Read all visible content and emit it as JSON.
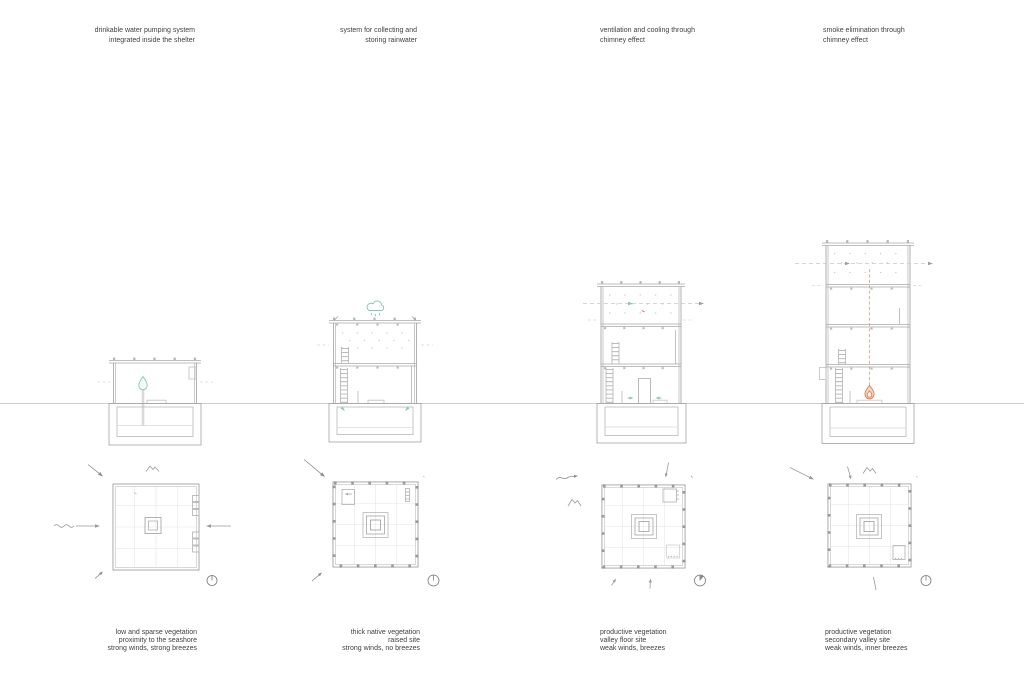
{
  "page": {
    "background": "#ffffff",
    "description": "architectural diagram of four shelter variants: sections over a shared ground line, site plans below, environmental strategy notes top and site condition notes bottom"
  },
  "colors": {
    "ground_line": "#cccccc",
    "wall_line": "#9f9f9f",
    "light_line": "#c6c6c6",
    "text": "#3f3f3f",
    "accent_teal": "#84c7b5",
    "accent_orange": "#e0784e"
  },
  "icons": {
    "water_drop": "water-drop-icon",
    "rain_cloud": "rain-cloud-icon",
    "flame": "flame-icon",
    "airflow_arrow": "airflow-arrow-icon",
    "wind_arrow": "wind-arrow-icon",
    "breeze_arrow": "breeze-arrow-icon",
    "sea_waves": "sea-waves-icon",
    "mountain": "mountain-icon",
    "north_arrow": "north-arrow-icon"
  },
  "columns": [
    {
      "top_note": {
        "align": "right",
        "lines": [
          "drinkable water pumping system",
          "integrated inside the shelter"
        ]
      },
      "bottom_note": {
        "align": "right",
        "lines": [
          "low and sparse vegetation",
          "proximity to the seashore",
          "strong winds, strong breezes"
        ]
      },
      "section": {
        "name": "section-1",
        "floors": 1,
        "feature_icons": [
          "water-drop-icon"
        ]
      },
      "plan": {
        "name": "plan-1",
        "site_icons": [
          "wind-arrow-icon",
          "mountain-icon",
          "sea-waves-icon",
          "breeze-arrow-icon",
          "north-arrow-icon"
        ]
      }
    },
    {
      "top_note": {
        "align": "right",
        "lines": [
          "system for collecting and",
          "storing rainwater"
        ]
      },
      "bottom_note": {
        "align": "right",
        "lines": [
          "thick native vegetation",
          "raised site",
          "strong winds, no breezes"
        ]
      },
      "section": {
        "name": "section-2",
        "floors": 2,
        "feature_icons": [
          "rain-cloud-icon"
        ]
      },
      "plan": {
        "name": "plan-2",
        "site_icons": [
          "wind-arrow-icon",
          "breeze-arrow-icon",
          "north-arrow-icon"
        ]
      }
    },
    {
      "top_note": {
        "align": "left",
        "lines": [
          "ventilation and cooling through",
          "chimney effect"
        ]
      },
      "bottom_note": {
        "align": "left",
        "lines": [
          "productive vegetation",
          "valley floor site",
          "weak winds, breezes"
        ]
      },
      "section": {
        "name": "section-3",
        "floors": 3,
        "feature_icons": [
          "airflow-arrow-icon"
        ]
      },
      "plan": {
        "name": "plan-3",
        "site_icons": [
          "breeze-arrow-icon",
          "mountain-icon",
          "north-arrow-icon"
        ]
      }
    },
    {
      "top_note": {
        "align": "left",
        "lines": [
          "smoke elimination through",
          "chimney effect"
        ]
      },
      "bottom_note": {
        "align": "left",
        "lines": [
          "productive vegetation",
          "secondary valley site",
          "weak winds, inner breezes"
        ]
      },
      "section": {
        "name": "section-4",
        "floors": 4,
        "feature_icons": [
          "flame-icon",
          "airflow-arrow-icon"
        ]
      },
      "plan": {
        "name": "plan-4",
        "site_icons": [
          "wind-arrow-icon",
          "mountain-icon",
          "north-arrow-icon"
        ]
      }
    }
  ]
}
